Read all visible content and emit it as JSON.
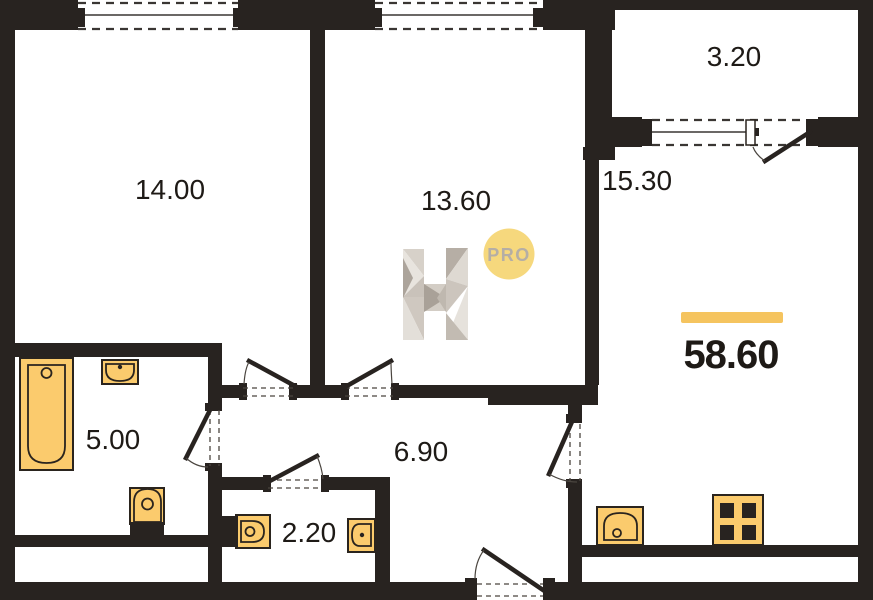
{
  "plan": {
    "rooms": [
      {
        "name": "bedroom",
        "area": "14.00"
      },
      {
        "name": "room",
        "area": "13.60"
      },
      {
        "name": "kitchen-living",
        "area": "15.30"
      },
      {
        "name": "balcony",
        "area": "3.20"
      },
      {
        "name": "bathroom",
        "area": "5.00"
      },
      {
        "name": "hallway",
        "area": "6.90"
      },
      {
        "name": "wc",
        "area": "2.20"
      }
    ],
    "total_area": "58.60",
    "logo": {
      "badge": "PRO"
    },
    "colors": {
      "wall": "#282320",
      "fixture": "#FBCB6D",
      "outline": "#2A241E",
      "accent": "#F5C45F",
      "badge_bg": "#F6D87D",
      "badge_text": "#B5AEA5",
      "text": "#1E1A16"
    }
  }
}
